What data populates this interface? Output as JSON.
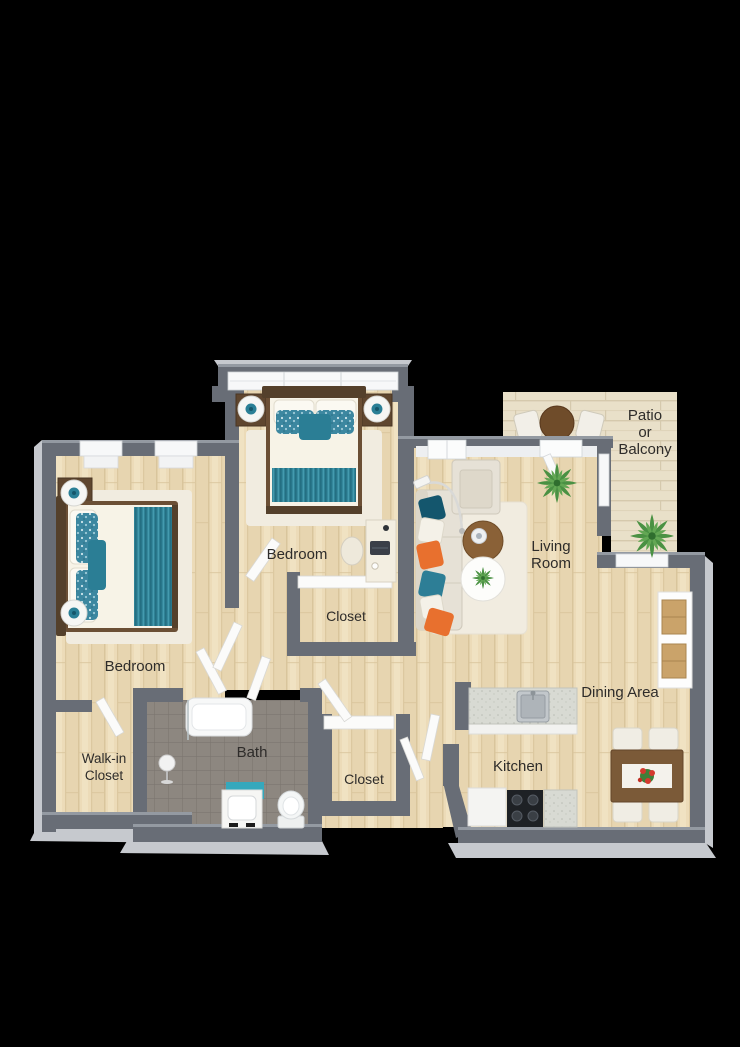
{
  "figure": {
    "type": "3d-floor-plan",
    "description": "Top-down 3D rendered apartment floor plan, two bedrooms, on black background",
    "background": "#000000"
  },
  "rooms": {
    "bedroom1": {
      "label": "Bedroom"
    },
    "bedroom2": {
      "label": "Bedroom"
    },
    "closet2": {
      "label": "Closet"
    },
    "living": {
      "line1": "Living",
      "line2": "Room"
    },
    "patio": {
      "line1": "Patio",
      "line2": "or",
      "line3": "Balcony"
    },
    "dining": {
      "label": "Dining Area"
    },
    "kitchen": {
      "label": "Kitchen"
    },
    "bath": {
      "label": "Bath"
    },
    "walkin": {
      "line1": "Walk-in",
      "line2": "Closet"
    },
    "closet_hall": {
      "label": "Closet"
    }
  },
  "palette": {
    "wall": "#686d76",
    "wall_base": "#c6c9ce",
    "floor_wood": "#ecdbb8",
    "floor_tile": "#8d8780",
    "floor_patio": "#e9e0c9",
    "accent_teal": "#2f8296",
    "accent_dark_teal": "#14566d",
    "accent_orange": "#e8702e",
    "fabric_cream": "#e6e1d6",
    "wood_dark": "#5d452f",
    "wood_table": "#7b5a38",
    "bath_mat_teal": "#35a8bc",
    "text": "#2e2c2a"
  },
  "furniture_icons": [
    "double-bed",
    "double-bed",
    "nightstand",
    "nightstand",
    "nightstand",
    "nightstand",
    "table-lamp",
    "table-lamp",
    "table-lamp",
    "table-lamp",
    "desk",
    "desk-chair",
    "laptop",
    "sofa",
    "armchair",
    "floor-lamp",
    "coffee-table",
    "side-table",
    "area-rug",
    "potted-plant",
    "potted-plant",
    "patio-table",
    "patio-chair",
    "patio-chair",
    "dining-table",
    "dining-chair",
    "dining-chair",
    "dining-chair",
    "dining-chair",
    "bookshelf",
    "kitchen-sink",
    "cooktop",
    "refrigerator",
    "bathtub",
    "toilet",
    "vanity-sink",
    "bath-mat",
    "towel-stand"
  ]
}
